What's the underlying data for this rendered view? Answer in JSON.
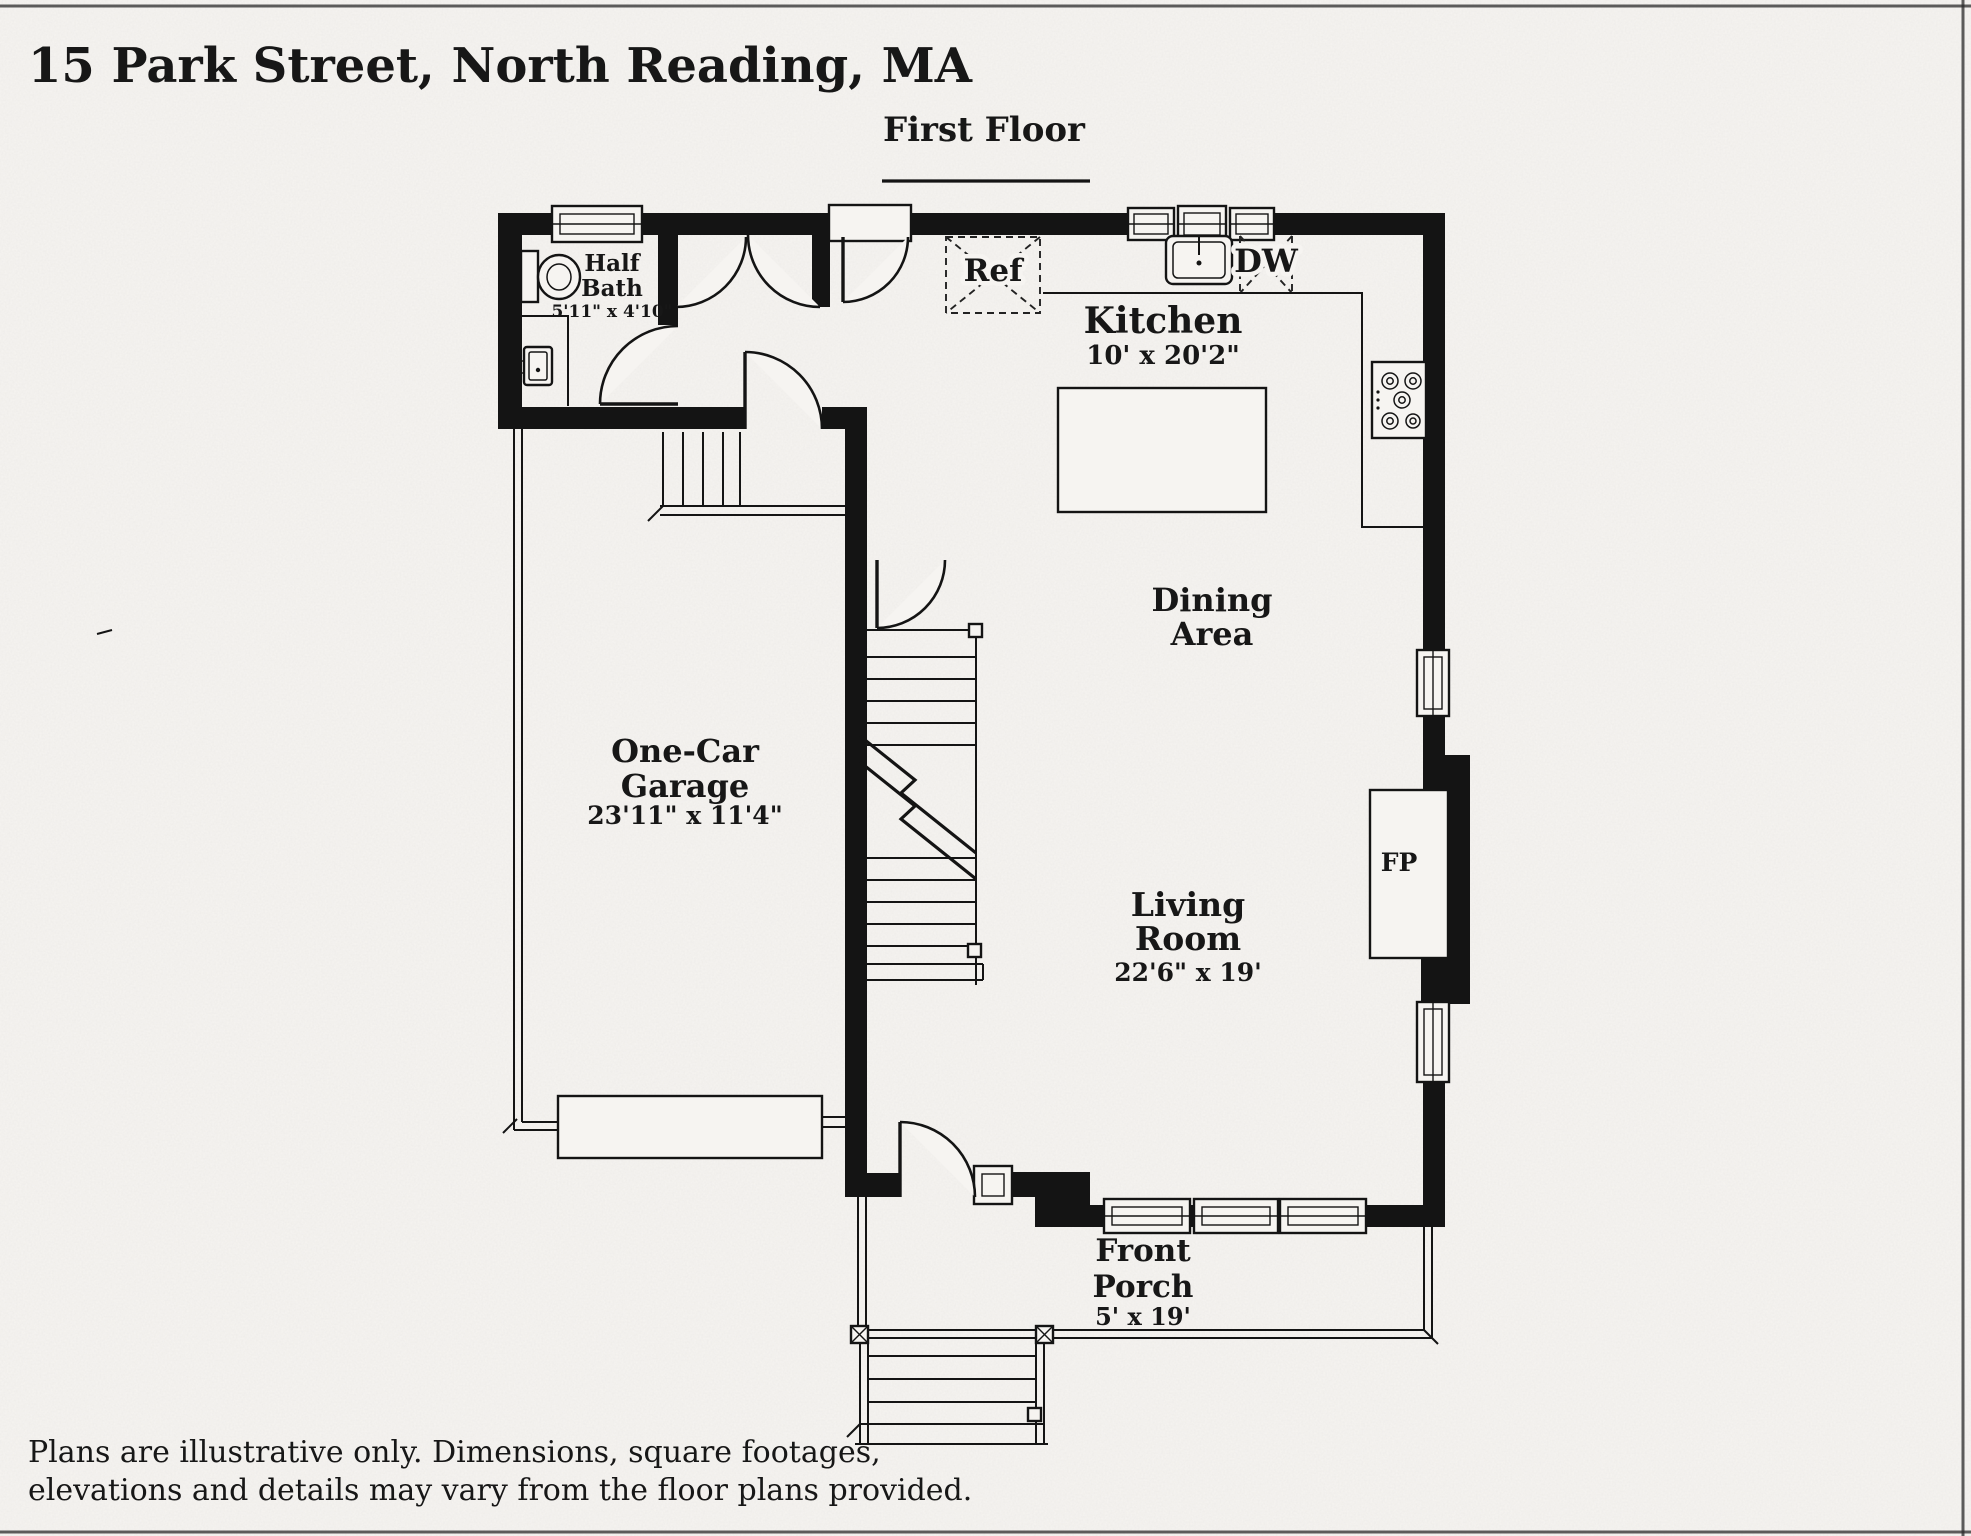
{
  "page": {
    "title": "15 Park Street, North Reading, MA",
    "floor_label": "First Floor",
    "disclaimer": {
      "line1": "Plans are illustrative only. Dimensions, square footages,",
      "line2": "elevations and details may vary from the floor plans provided."
    }
  },
  "rooms": {
    "half_bath": {
      "line1": "Half",
      "line2": "Bath",
      "dims": "5'11\" x 4'10\""
    },
    "kitchen": {
      "line1": "Kitchen",
      "dims": "10' x 20'2\""
    },
    "dining": {
      "line1": "Dining",
      "line2": "Area"
    },
    "garage": {
      "line1": "One-Car",
      "line2": "Garage",
      "dims": "23'11\" x 11'4\""
    },
    "living": {
      "line1": "Living",
      "line2": "Room",
      "dims": "22'6\" x 19'"
    },
    "porch": {
      "line1": "Front",
      "line2": "Porch",
      "dims": "5' x 19'"
    }
  },
  "appliances": {
    "refrigerator": "Ref",
    "dishwasher": "DW",
    "fireplace": "FP"
  }
}
